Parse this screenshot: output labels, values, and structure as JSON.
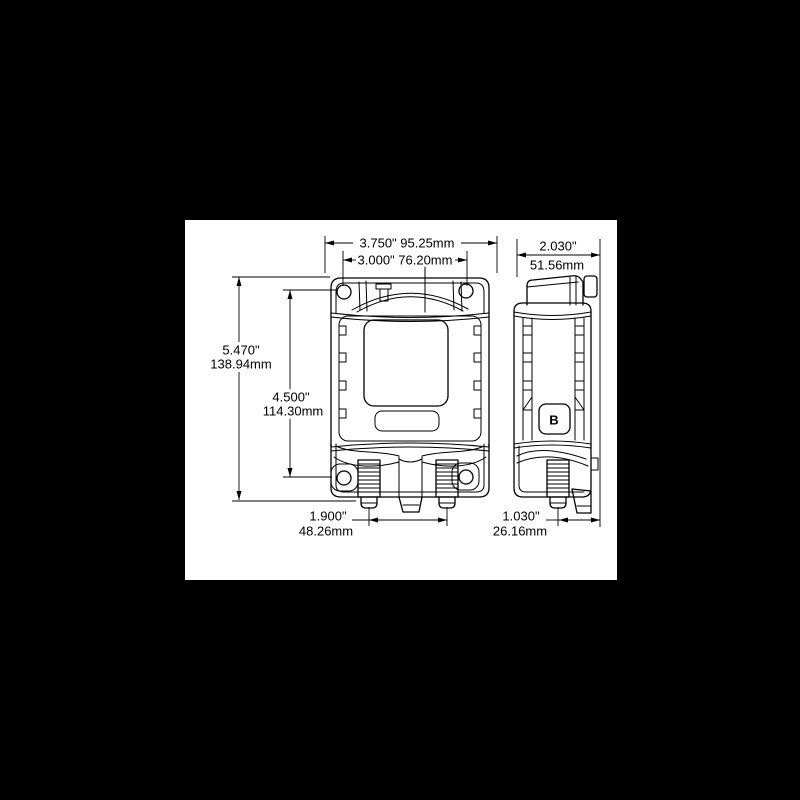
{
  "scene": {
    "background_color": "#000000",
    "canvas_color": "#ffffff",
    "line_color": "#000000"
  },
  "drawing": {
    "side_marking": "B",
    "dims": {
      "overall_width": {
        "label": "3.750\" 95.25mm"
      },
      "hole_spacing_x": {
        "label": "3.000\" 76.20mm"
      },
      "depth": {
        "inches": "2.030\"",
        "mm": "51.56mm"
      },
      "overall_height": {
        "inches": "5.470\"",
        "mm": "138.94mm"
      },
      "hole_spacing_y": {
        "inches": "4.500\"",
        "mm": "114.30mm"
      },
      "stud_spacing": {
        "inches": "1.900\"",
        "mm": "48.26mm"
      },
      "stud_offset": {
        "inches": "1.030\"",
        "mm": "26.16mm"
      }
    }
  }
}
